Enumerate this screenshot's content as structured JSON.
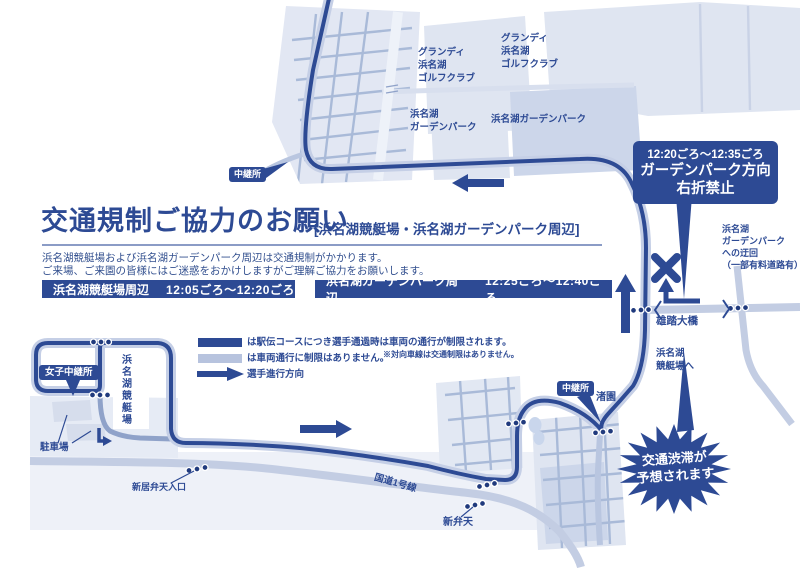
{
  "colors": {
    "navy": "#2d4a94",
    "course_casing": "#c5cfe6",
    "medium_road": "#8fa2c9",
    "highway_road": "#c3cde3",
    "land": "#e2e7f3",
    "land_dark": "#ccd6ea",
    "grid_street": "#a9bad8",
    "legend_light_bar": "#b7c3de",
    "white": "#ffffff"
  },
  "header": {
    "title": "交通規制ご協力のお願い",
    "subtitle": "[浜名湖競艇場・浜名湖ガーデンパーク周辺]",
    "body_line1": "浜名湖競艇場および浜名湖ガーデンパーク周辺は交通規制がかかります。",
    "body_line2": "ご来場、ご来園の皆様にはご迷惑をおかけしますがご理解ご協力をお願いします。",
    "time_bars": [
      {
        "label": "浜名湖競艇場周辺",
        "time": "12:05ごろ〜12:20ごろ"
      },
      {
        "label": "浜名湖ガーデンパーク周辺",
        "time": "12:25ごろ〜12:40ごろ"
      }
    ]
  },
  "legend": {
    "course_text": "は駅伝コースにつき選手通過時は車両の通行が制限されます。",
    "normal_text": "は車両通行に制限はありません。",
    "note": "※対向車線は交通制限はありません。",
    "direction_text": "選手進行方向"
  },
  "callouts": {
    "restriction": {
      "time": "12:20ごろ〜12:35ごろ",
      "line1": "ガーデンパーク方向",
      "line2": "右折禁止"
    },
    "relay_top": "中継所",
    "relay_mid": "中継所",
    "women_relay": "女子中継所",
    "congestion": "交通渋滞が\n予想されます"
  },
  "map_labels": {
    "golf_club_1": "グランディ\n浜名湖\nゴルフクラブ",
    "golf_club_2": "グランディ\n浜名湖\nゴルフクラブ",
    "garden_park_1": "浜名湖\nガーデンパーク",
    "garden_park_2": "浜名湖ガーデンパーク",
    "nagisaen": "渚園",
    "yuto_bridge": "雄踏大橋",
    "to_boat_race": "浜名湖\n競艇場へ",
    "detour": "浜名湖\nガーデンパーク\nへの迂回\n（一部有料道路有）",
    "boat_race_stadium": "浜名湖競艇場",
    "parking": "駐車場",
    "benten_entrance": "新居弁天入口",
    "shinbenten": "新弁天",
    "route1": "国道1号線"
  }
}
